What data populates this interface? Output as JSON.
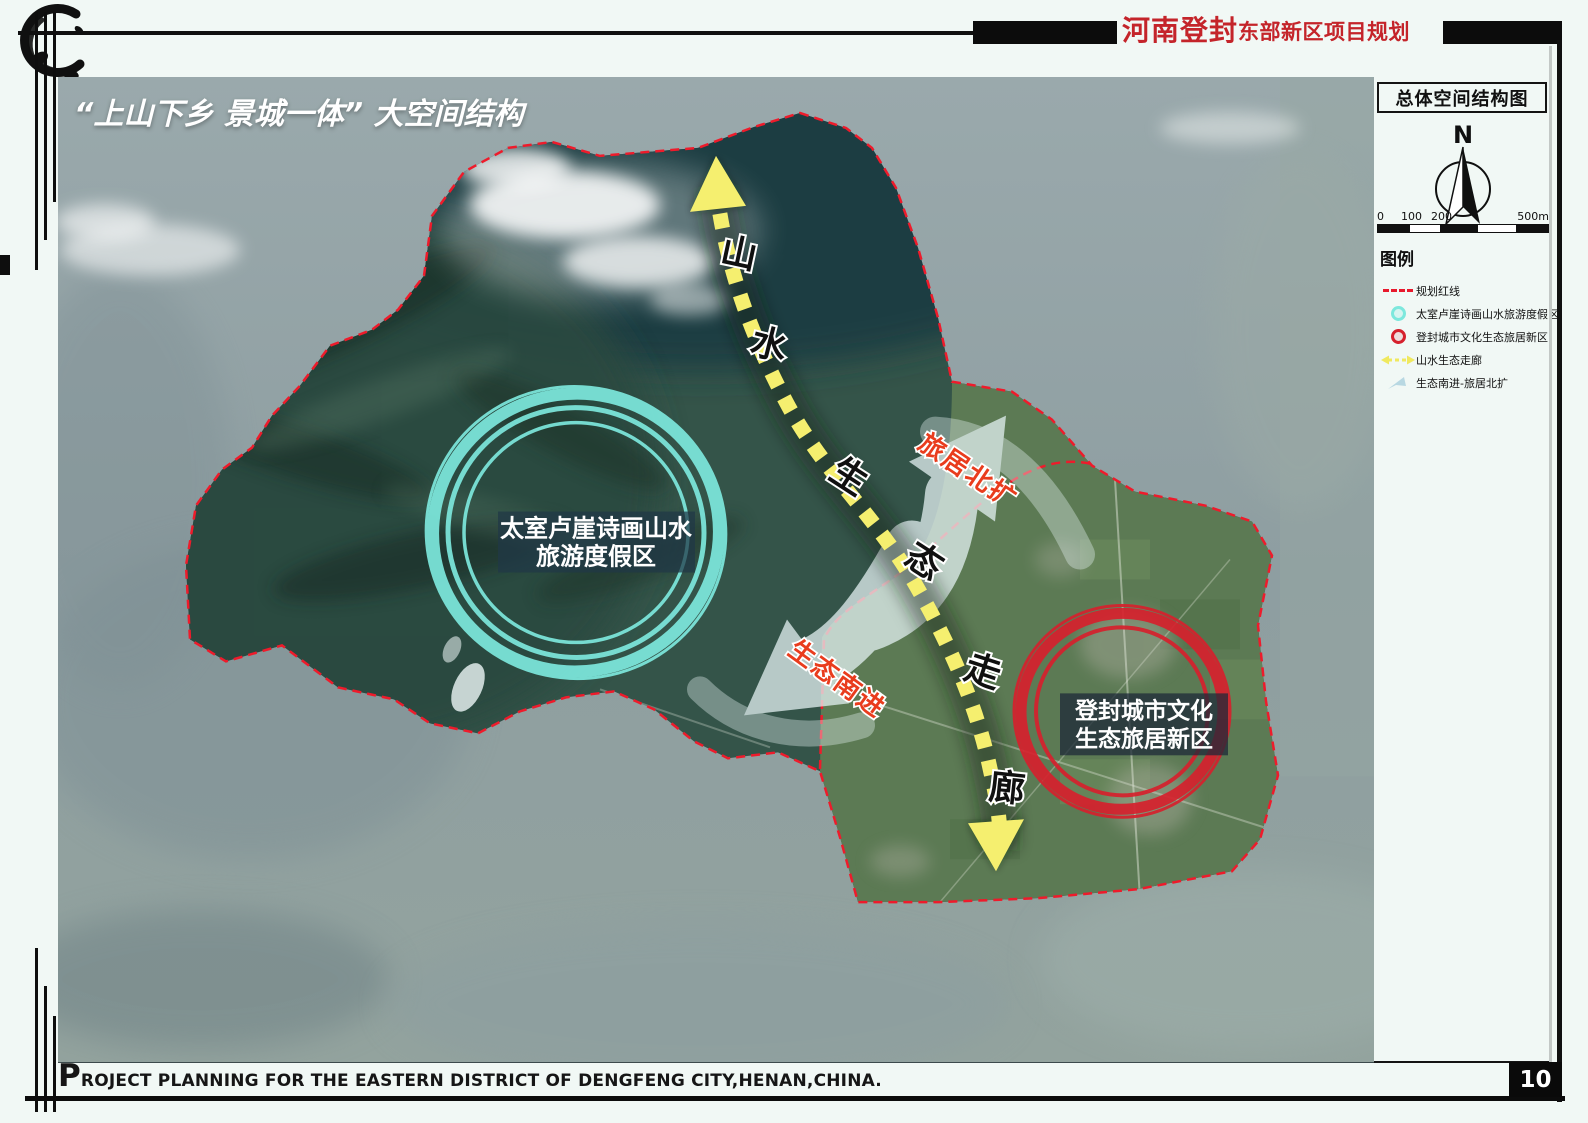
{
  "header": {
    "title_main": "河南登封",
    "title_sub": "东部新区项目规划"
  },
  "map": {
    "title": "“上山下乡 景城一体” 大空间结构",
    "zone_cyan": {
      "label_line1": "太室卢崖诗画山水",
      "label_line2": "旅游度假区"
    },
    "zone_red": {
      "label_line1": "登封城市文化",
      "label_line2": "生态旅居新区"
    },
    "corridor_chars": [
      "山",
      "水",
      "生",
      "态",
      "走",
      "廊"
    ],
    "arrow_ne_label": "旅居北扩",
    "arrow_sw_label": "生态南进"
  },
  "sidebar": {
    "panel_title": "总体空间结构图",
    "compass_n": "N",
    "scale_ticks": [
      "0",
      "100",
      "200",
      "500m"
    ],
    "legend_title": "图例",
    "legend_items": [
      {
        "swatch": "red-dashed-line",
        "label": "规划红线"
      },
      {
        "swatch": "cyan-circle",
        "label": "太室卢崖诗画山水旅游度假区"
      },
      {
        "swatch": "red-circle",
        "label": "登封城市文化生态旅居新区"
      },
      {
        "swatch": "yellow-dashed-arrow",
        "label": "山水生态走廊"
      },
      {
        "swatch": "blue-flow-arrow",
        "label": "生态南进-旅居北扩"
      }
    ]
  },
  "footer": {
    "caption": "PROJECT PLANNING FOR THE EASTERN DISTRICT OF DENGFENG CITY,HENAN,CHINA.",
    "page_number": "10"
  },
  "colors": {
    "header_red": "#c4242a",
    "boundary_red": "#ee1b2b",
    "corridor_yellow": "#f5ef6f",
    "resort_cyan": "#7de8dd",
    "newtown_red": "#d6212d",
    "flow_arrow_blue": "#e3f1f2"
  }
}
